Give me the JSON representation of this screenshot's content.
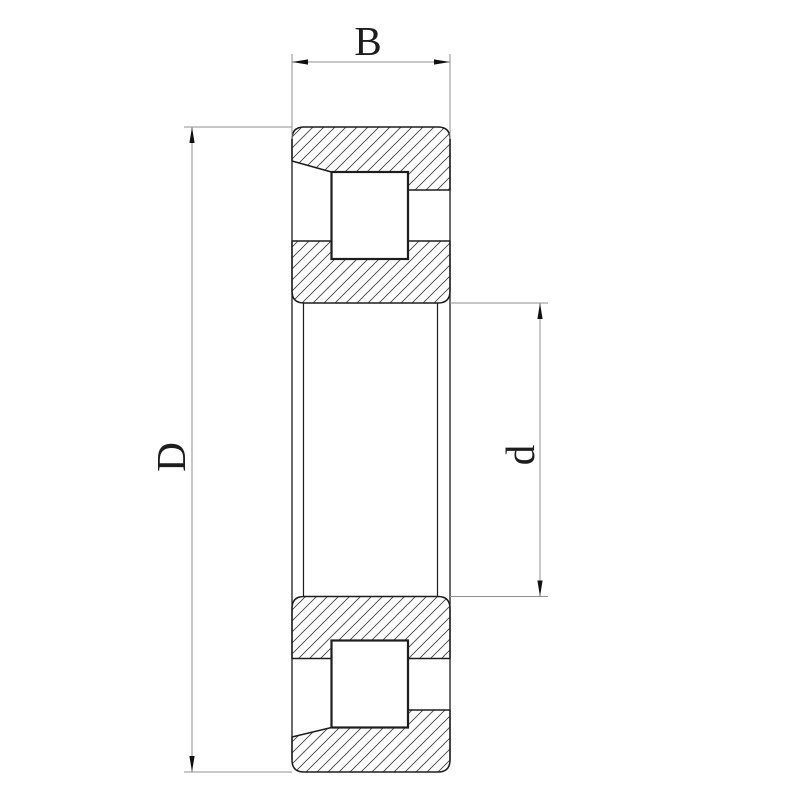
{
  "diagram": {
    "kind": "cylindrical-roller-bearing-cross-section",
    "labels": {
      "width_dim": "B",
      "outer_diameter_dim": "D",
      "bore_diameter_dim": "d"
    },
    "colors": {
      "background": "#ffffff",
      "outline": "#1d1d1d",
      "hatch": "#444444",
      "dimension_line": "#8f8f8f",
      "arrow": "#101010",
      "roller_fill": "#ffffff"
    }
  }
}
